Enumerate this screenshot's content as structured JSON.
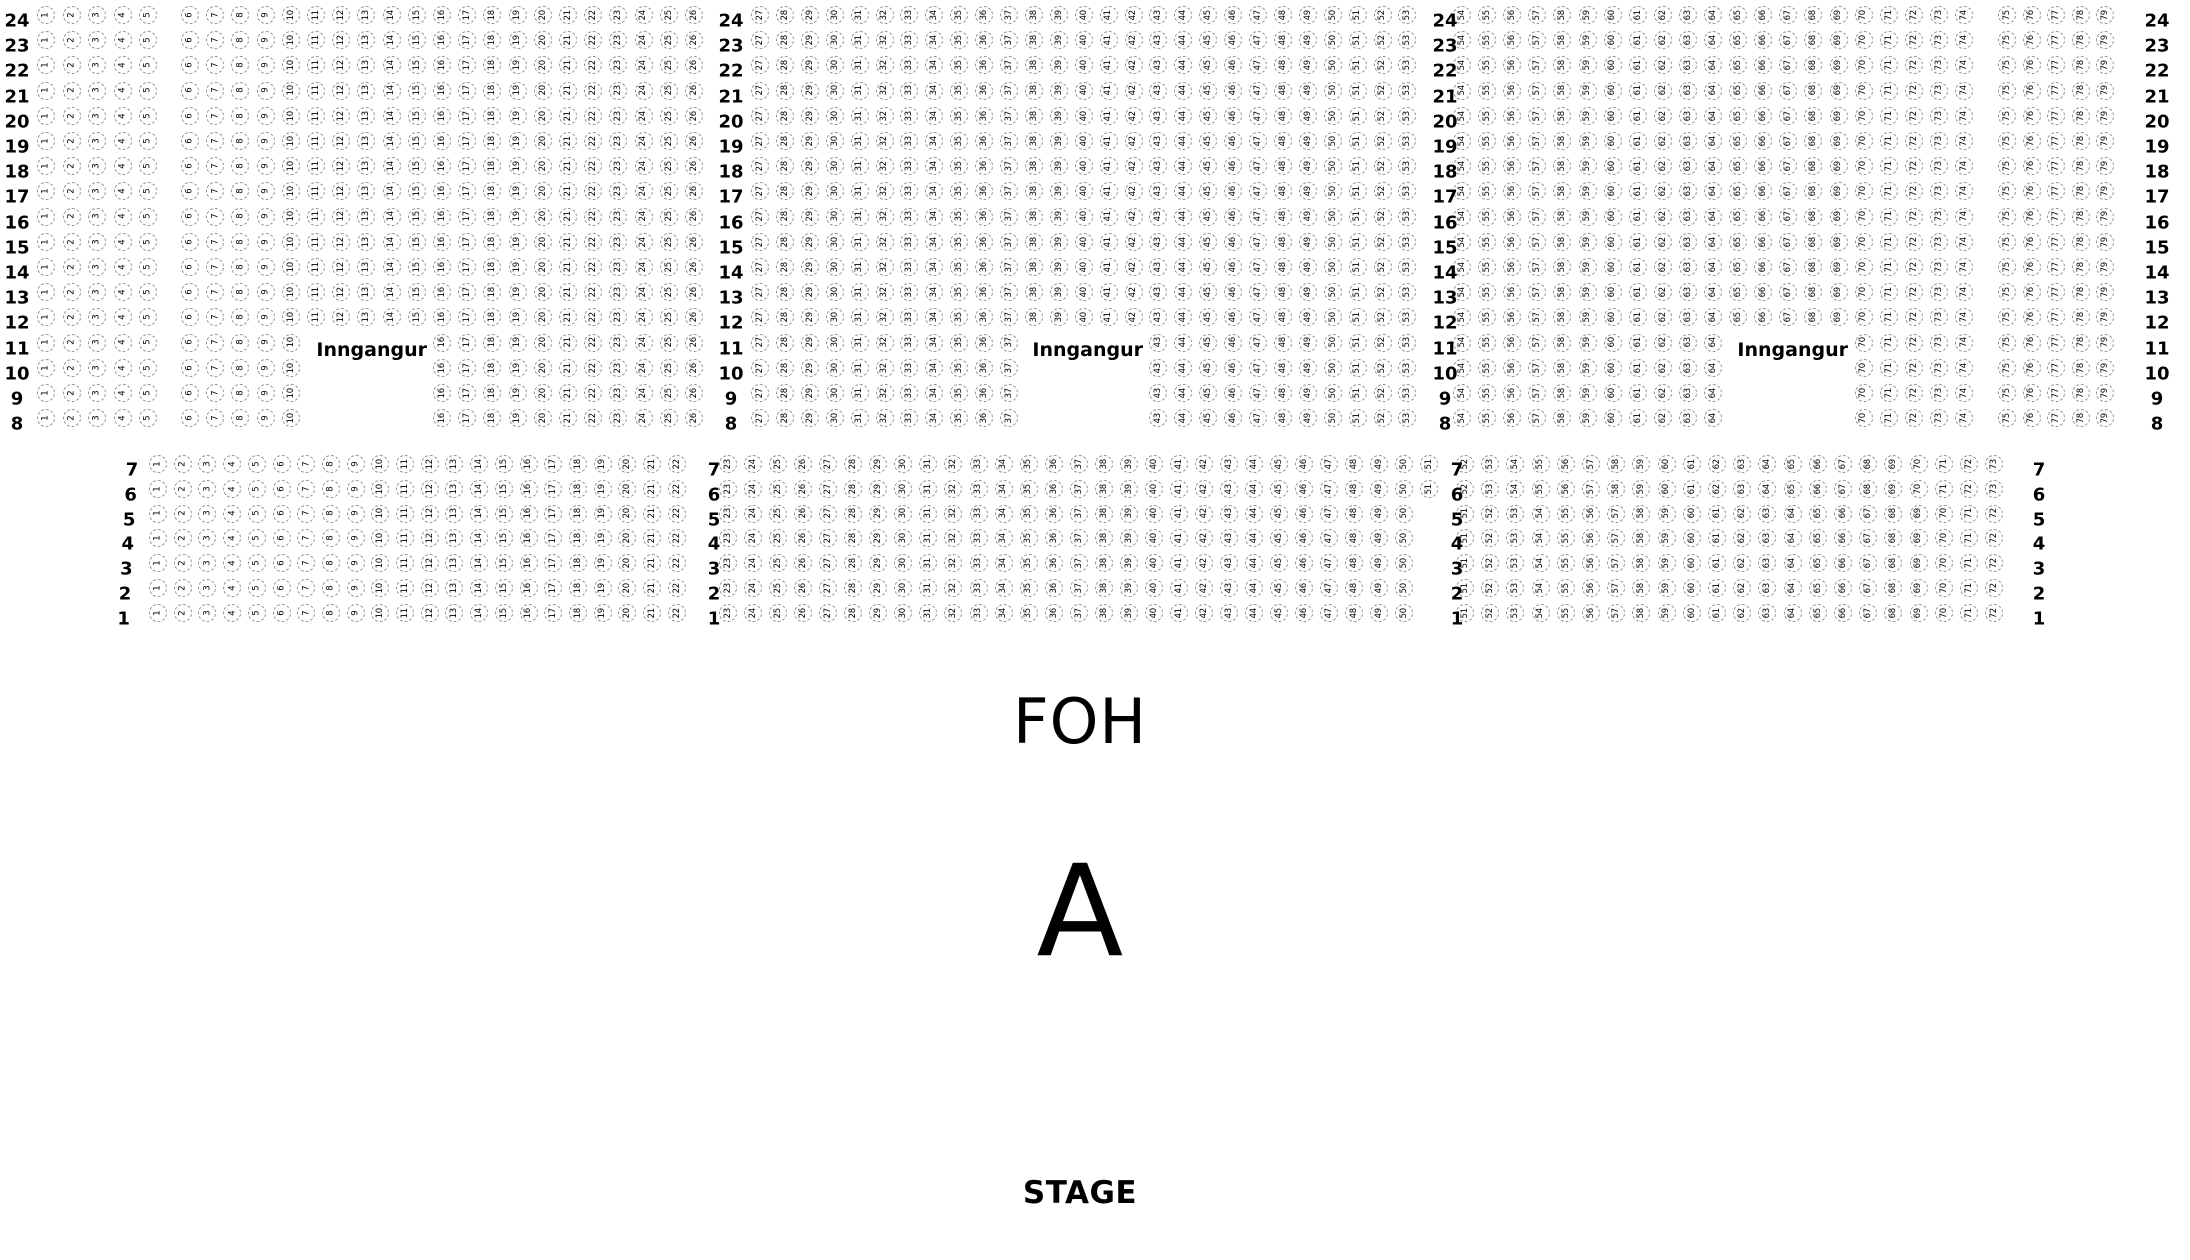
{
  "labels": {
    "foh": "FOH",
    "section": "A",
    "stage": "STAGE"
  },
  "entrances": {
    "label": "Inngangur",
    "count": 3
  },
  "colors": {
    "background": "#ffffff",
    "seat_outline": "#949494",
    "seat_number": "#000000",
    "label_text": "#000000"
  },
  "upper_section": {
    "row_labels": [
      24,
      23,
      22,
      21,
      20,
      19,
      18,
      17,
      16,
      15,
      14,
      13,
      12,
      11,
      10,
      9,
      8
    ],
    "label_column_count": 4,
    "rows": [
      {
        "row": 24,
        "seat_ranges": [
          [
            1,
            5
          ],
          [
            6,
            26
          ],
          [
            27,
            53
          ],
          [
            54,
            74
          ],
          [
            75,
            79
          ]
        ]
      },
      {
        "row": 23,
        "seat_ranges": [
          [
            1,
            5
          ],
          [
            6,
            26
          ],
          [
            27,
            53
          ],
          [
            54,
            74
          ],
          [
            75,
            79
          ]
        ]
      },
      {
        "row": 22,
        "seat_ranges": [
          [
            1,
            5
          ],
          [
            6,
            26
          ],
          [
            27,
            53
          ],
          [
            54,
            74
          ],
          [
            75,
            79
          ]
        ]
      },
      {
        "row": 21,
        "seat_ranges": [
          [
            1,
            5
          ],
          [
            6,
            26
          ],
          [
            27,
            53
          ],
          [
            54,
            74
          ],
          [
            75,
            79
          ]
        ]
      },
      {
        "row": 20,
        "seat_ranges": [
          [
            1,
            5
          ],
          [
            6,
            26
          ],
          [
            27,
            53
          ],
          [
            54,
            74
          ],
          [
            75,
            79
          ]
        ]
      },
      {
        "row": 19,
        "seat_ranges": [
          [
            1,
            5
          ],
          [
            6,
            26
          ],
          [
            27,
            53
          ],
          [
            54,
            74
          ],
          [
            75,
            79
          ]
        ]
      },
      {
        "row": 18,
        "seat_ranges": [
          [
            1,
            5
          ],
          [
            6,
            26
          ],
          [
            27,
            53
          ],
          [
            54,
            74
          ],
          [
            75,
            79
          ]
        ]
      },
      {
        "row": 17,
        "seat_ranges": [
          [
            1,
            5
          ],
          [
            6,
            26
          ],
          [
            27,
            53
          ],
          [
            54,
            74
          ],
          [
            75,
            79
          ]
        ]
      },
      {
        "row": 16,
        "seat_ranges": [
          [
            1,
            5
          ],
          [
            6,
            26
          ],
          [
            27,
            53
          ],
          [
            54,
            74
          ],
          [
            75,
            79
          ]
        ]
      },
      {
        "row": 15,
        "seat_ranges": [
          [
            1,
            5
          ],
          [
            6,
            26
          ],
          [
            27,
            53
          ],
          [
            54,
            74
          ],
          [
            75,
            79
          ]
        ]
      },
      {
        "row": 14,
        "seat_ranges": [
          [
            1,
            5
          ],
          [
            6,
            26
          ],
          [
            27,
            53
          ],
          [
            54,
            74
          ],
          [
            75,
            79
          ]
        ]
      },
      {
        "row": 13,
        "seat_ranges": [
          [
            1,
            5
          ],
          [
            6,
            26
          ],
          [
            27,
            53
          ],
          [
            54,
            74
          ],
          [
            75,
            79
          ]
        ]
      },
      {
        "row": 12,
        "seat_ranges": [
          [
            1,
            5
          ],
          [
            6,
            26
          ],
          [
            27,
            53
          ],
          [
            54,
            74
          ],
          [
            75,
            79
          ]
        ]
      },
      {
        "row": 11,
        "seat_ranges": [
          [
            1,
            5
          ],
          [
            6,
            10
          ],
          [
            16,
            26
          ],
          [
            27,
            37
          ],
          [
            43,
            53
          ],
          [
            54,
            64
          ],
          [
            70,
            74
          ],
          [
            75,
            79
          ]
        ]
      },
      {
        "row": 10,
        "seat_ranges": [
          [
            1,
            5
          ],
          [
            6,
            10
          ],
          [
            16,
            26
          ],
          [
            27,
            37
          ],
          [
            43,
            53
          ],
          [
            54,
            64
          ],
          [
            70,
            74
          ],
          [
            75,
            79
          ]
        ]
      },
      {
        "row": 9,
        "seat_ranges": [
          [
            1,
            5
          ],
          [
            6,
            10
          ],
          [
            16,
            26
          ],
          [
            27,
            37
          ],
          [
            43,
            53
          ],
          [
            54,
            64
          ],
          [
            70,
            74
          ],
          [
            75,
            79
          ]
        ]
      },
      {
        "row": 8,
        "seat_ranges": [
          [
            1,
            5
          ],
          [
            6,
            10
          ],
          [
            16,
            26
          ],
          [
            27,
            37
          ],
          [
            43,
            53
          ],
          [
            54,
            64
          ],
          [
            70,
            74
          ],
          [
            75,
            79
          ]
        ]
      }
    ]
  },
  "lower_section": {
    "row_labels": [
      7,
      6,
      5,
      4,
      3,
      2,
      1
    ],
    "label_column_count": 4,
    "rows": [
      {
        "row": 7,
        "seat_ranges": [
          [
            1,
            22
          ],
          [
            23,
            51
          ],
          [
            52,
            73
          ]
        ]
      },
      {
        "row": 6,
        "seat_ranges": [
          [
            1,
            22
          ],
          [
            23,
            51
          ],
          [
            52,
            73
          ]
        ]
      },
      {
        "row": 5,
        "seat_ranges": [
          [
            1,
            22
          ],
          [
            23,
            50
          ],
          [
            51,
            72
          ]
        ]
      },
      {
        "row": 4,
        "seat_ranges": [
          [
            1,
            22
          ],
          [
            23,
            50
          ],
          [
            51,
            72
          ]
        ]
      },
      {
        "row": 3,
        "seat_ranges": [
          [
            1,
            22
          ],
          [
            23,
            50
          ],
          [
            51,
            72
          ]
        ]
      },
      {
        "row": 2,
        "seat_ranges": [
          [
            1,
            22
          ],
          [
            23,
            50
          ],
          [
            51,
            72
          ]
        ]
      },
      {
        "row": 1,
        "seat_ranges": [
          [
            1,
            22
          ],
          [
            23,
            50
          ],
          [
            51,
            72
          ]
        ]
      }
    ]
  }
}
